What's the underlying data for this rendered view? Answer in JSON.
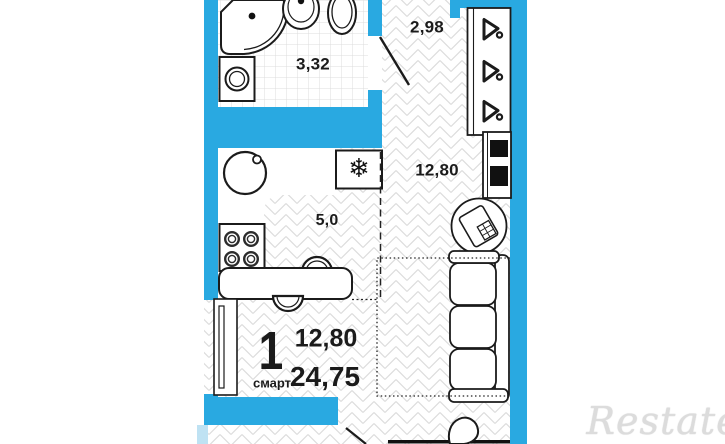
{
  "floorplan": {
    "rooms": {
      "bathroom": {
        "area": "3,32"
      },
      "hallway": {
        "area": "2,98"
      },
      "living_room": {
        "area": "12,80"
      },
      "kitchen": {
        "area": "5,0"
      }
    },
    "summary": {
      "rooms_count": "1",
      "plan_type": "смарт",
      "living_area": "12,80",
      "total_area": "24,75"
    },
    "icons": {
      "freezer": "❄"
    },
    "colors": {
      "wall": "#29a9e1",
      "wall_light": "#bfe2f3",
      "outline": "#1b1b1b",
      "floor_pattern": "#dcdcdc",
      "watermark": "#dcdcdc"
    }
  },
  "watermark": {
    "text": "Restate"
  }
}
